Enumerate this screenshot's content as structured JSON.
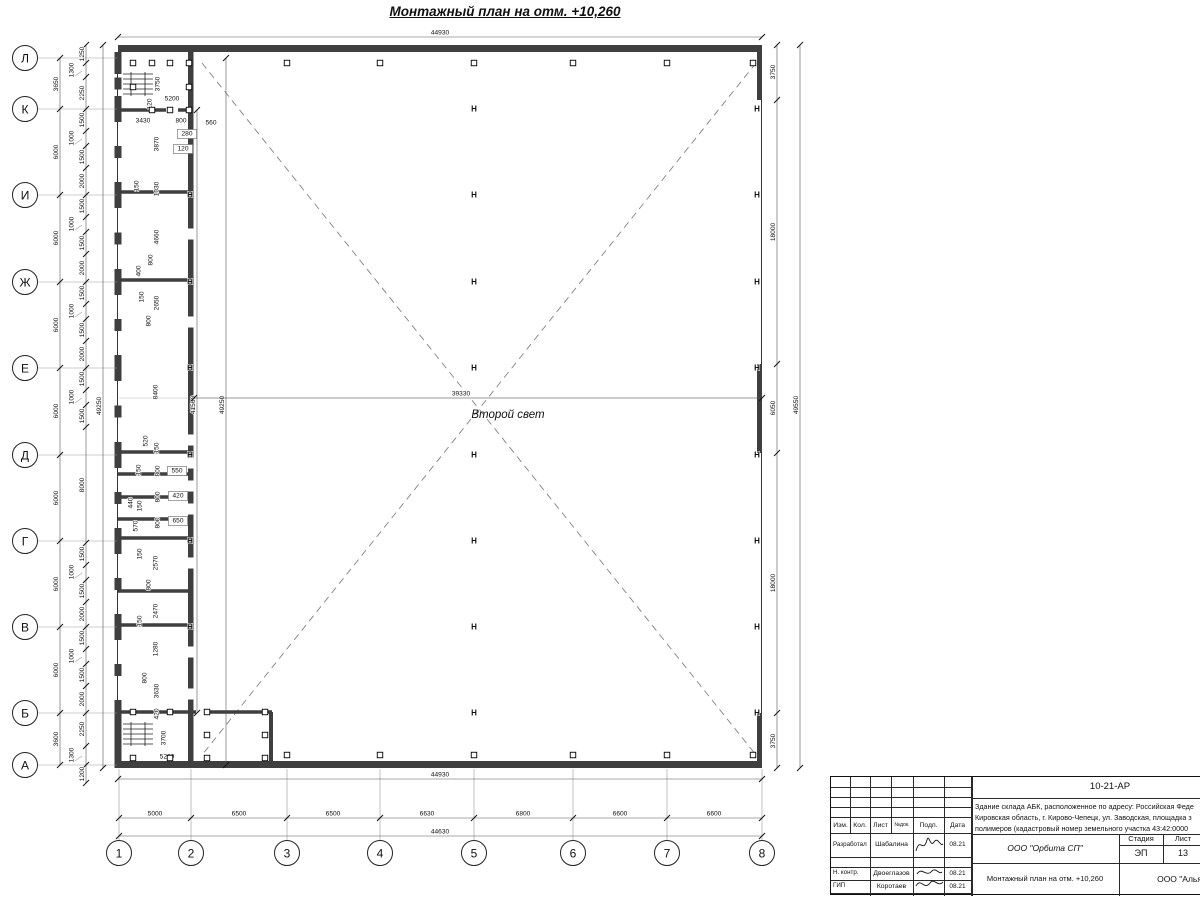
{
  "page_title": "Монтажный план на отм. +10,260",
  "plan": {
    "center_room_label": "Второй свет",
    "axes": {
      "rows": [
        {
          "label": "Л",
          "y": 58
        },
        {
          "label": "К",
          "y": 109
        },
        {
          "label": "И",
          "y": 195
        },
        {
          "label": "Ж",
          "y": 282
        },
        {
          "label": "Е",
          "y": 368
        },
        {
          "label": "Д",
          "y": 455
        },
        {
          "label": "Г",
          "y": 541
        },
        {
          "label": "В",
          "y": 627
        },
        {
          "label": "Б",
          "y": 713
        },
        {
          "label": "А",
          "y": 765
        }
      ],
      "cols": [
        {
          "label": "1",
          "x": 119
        },
        {
          "label": "2",
          "x": 191
        },
        {
          "label": "3",
          "x": 287
        },
        {
          "label": "4",
          "x": 380
        },
        {
          "label": "5",
          "x": 474
        },
        {
          "label": "6",
          "x": 573
        },
        {
          "label": "7",
          "x": 667
        },
        {
          "label": "8",
          "x": 762
        }
      ]
    },
    "chains": [
      {
        "dir": "h",
        "pos": 37,
        "nodes": [
          118,
          762
        ],
        "labels": [
          {
            "t": "44930",
            "at": 440
          }
        ]
      },
      {
        "dir": "h",
        "pos": 779,
        "nodes": [
          118,
          762
        ],
        "labels": [
          {
            "t": "44930",
            "at": 440
          }
        ]
      },
      {
        "dir": "h",
        "pos": 818,
        "nodes": [
          119,
          191,
          287,
          380,
          474,
          573,
          667,
          762
        ],
        "labels": [
          {
            "t": "5000",
            "at": 155
          },
          {
            "t": "6500",
            "at": 239
          },
          {
            "t": "6500",
            "at": 333
          },
          {
            "t": "6630",
            "at": 427
          },
          {
            "t": "6800",
            "at": 523
          },
          {
            "t": "6600",
            "at": 620
          },
          {
            "t": "6600",
            "at": 714
          }
        ]
      },
      {
        "dir": "h",
        "pos": 836,
        "nodes": [
          119,
          762
        ],
        "labels": [
          {
            "t": "44630",
            "at": 440
          }
        ]
      },
      {
        "dir": "v",
        "pos": 60,
        "nodes": [
          58,
          109,
          195,
          282,
          368,
          455,
          541,
          627,
          713,
          765
        ],
        "labels": [
          {
            "t": "3650",
            "at": 84
          },
          {
            "t": "6000",
            "at": 152
          },
          {
            "t": "6000",
            "at": 238
          },
          {
            "t": "6000",
            "at": 325
          },
          {
            "t": "6000",
            "at": 411
          },
          {
            "t": "6000",
            "at": 498
          },
          {
            "t": "6000",
            "at": 584
          },
          {
            "t": "6000",
            "at": 670
          },
          {
            "t": "3600",
            "at": 739
          }
        ]
      },
      {
        "dir": "v",
        "pos": 103,
        "nodes": [
          45,
          768
        ],
        "labels": [
          {
            "t": "49250",
            "at": 406
          }
        ]
      },
      {
        "dir": "v",
        "pos": 86,
        "nodes": [
          45,
          63,
          77,
          109,
          131,
          146,
          168,
          195,
          217,
          232,
          254,
          282,
          304,
          319,
          341,
          368,
          390,
          405,
          427,
          543,
          565,
          580,
          602,
          627,
          649,
          664,
          686,
          713,
          746,
          765,
          783
        ],
        "labels": [
          {
            "t": "1250",
            "at": 54
          },
          {
            "t": "1300",
            "at": 70,
            "l": 1
          },
          {
            "t": "2250",
            "at": 93
          },
          {
            "t": "1500",
            "at": 120
          },
          {
            "t": "1000",
            "at": 138,
            "l": 1
          },
          {
            "t": "1500",
            "at": 157
          },
          {
            "t": "2000",
            "at": 181
          },
          {
            "t": "1500",
            "at": 206
          },
          {
            "t": "1000",
            "at": 224,
            "l": 1
          },
          {
            "t": "1500",
            "at": 243
          },
          {
            "t": "2000",
            "at": 268
          },
          {
            "t": "1500",
            "at": 293
          },
          {
            "t": "1000",
            "at": 311,
            "l": 1
          },
          {
            "t": "1500",
            "at": 330
          },
          {
            "t": "2000",
            "at": 354
          },
          {
            "t": "1500",
            "at": 379
          },
          {
            "t": "1000",
            "at": 397,
            "l": 1
          },
          {
            "t": "1500",
            "at": 416
          },
          {
            "t": "8000",
            "at": 485
          },
          {
            "t": "1500",
            "at": 554
          },
          {
            "t": "1000",
            "at": 572,
            "l": 1
          },
          {
            "t": "1500",
            "at": 591
          },
          {
            "t": "2000",
            "at": 614
          },
          {
            "t": "1500",
            "at": 638
          },
          {
            "t": "1000",
            "at": 656,
            "l": 1
          },
          {
            "t": "1500",
            "at": 675
          },
          {
            "t": "2000",
            "at": 699
          },
          {
            "t": "2250",
            "at": 729
          },
          {
            "t": "1300",
            "at": 755,
            "l": 1
          },
          {
            "t": "1200",
            "at": 774
          }
        ]
      },
      {
        "dir": "v",
        "pos": 777,
        "nodes": [
          45,
          100,
          364,
          453,
          713,
          768
        ],
        "labels": [
          {
            "t": "3750",
            "at": 72
          },
          {
            "t": "18000",
            "at": 232
          },
          {
            "t": "6050",
            "at": 408
          },
          {
            "t": "18000",
            "at": 583
          },
          {
            "t": "3750",
            "at": 741
          }
        ]
      },
      {
        "dir": "v",
        "pos": 800,
        "nodes": [
          45,
          768
        ],
        "labels": [
          {
            "t": "49550",
            "at": 405
          }
        ]
      },
      {
        "dir": "v",
        "pos": 197,
        "nodes": [
          110,
          713
        ],
        "labels": [
          {
            "t": "41560",
            "at": 405
          }
        ]
      },
      {
        "dir": "v",
        "pos": 226,
        "nodes": [
          58,
          765
        ],
        "labels": [
          {
            "t": "49250",
            "at": 405
          }
        ]
      },
      {
        "dir": "h",
        "pos": 398,
        "nodes": [
          194,
          762
        ],
        "labels": [
          {
            "t": "39330",
            "at": 461
          }
        ]
      }
    ],
    "detail_dims": [
      [
        "3750",
        158,
        84,
        1,
        0
      ],
      [
        "5200",
        172,
        99,
        0,
        0
      ],
      [
        "120",
        150,
        104,
        1,
        0
      ],
      [
        "3430",
        143,
        121,
        0,
        0
      ],
      [
        "800",
        181,
        121,
        0,
        0
      ],
      [
        "560",
        211,
        123,
        0,
        0
      ],
      [
        "280",
        187,
        134,
        0,
        1
      ],
      [
        "120",
        183,
        149,
        0,
        1
      ],
      [
        "3870",
        157,
        144,
        1,
        0
      ],
      [
        "150",
        137,
        186,
        1,
        0
      ],
      [
        "1030",
        157,
        189,
        1,
        0
      ],
      [
        "4660",
        157,
        237,
        1,
        0
      ],
      [
        "800",
        151,
        260,
        1,
        0
      ],
      [
        "400",
        139,
        271,
        1,
        0
      ],
      [
        "150",
        142,
        297,
        1,
        0
      ],
      [
        "2650",
        157,
        303,
        1,
        0
      ],
      [
        "800",
        149,
        321,
        1,
        0
      ],
      [
        "8400",
        156,
        392,
        1,
        0
      ],
      [
        "520",
        146,
        441,
        1,
        0
      ],
      [
        "150",
        157,
        448,
        1,
        0
      ],
      [
        "150",
        139,
        470,
        1,
        0
      ],
      [
        "800",
        158,
        471,
        1,
        0
      ],
      [
        "550",
        177,
        471,
        0,
        1
      ],
      [
        "440",
        131,
        503,
        1,
        0
      ],
      [
        "150",
        140,
        506,
        1,
        0
      ],
      [
        "800",
        158,
        497,
        1,
        0
      ],
      [
        "420",
        178,
        496,
        0,
        1
      ],
      [
        "570",
        136,
        526,
        1,
        0
      ],
      [
        "800",
        158,
        523,
        1,
        0
      ],
      [
        "650",
        178,
        521,
        0,
        1
      ],
      [
        "150",
        140,
        554,
        1,
        0
      ],
      [
        "2570",
        156,
        563,
        1,
        0
      ],
      [
        "800",
        149,
        585,
        1,
        0
      ],
      [
        "2470",
        156,
        611,
        1,
        0
      ],
      [
        "150",
        140,
        621,
        1,
        0
      ],
      [
        "1280",
        156,
        649,
        1,
        0
      ],
      [
        "800",
        145,
        678,
        1,
        0
      ],
      [
        "3630",
        157,
        691,
        1,
        0
      ],
      [
        "420",
        157,
        714,
        1,
        0
      ],
      [
        "3700",
        164,
        738,
        1,
        0
      ],
      [
        "5200",
        167,
        757,
        0,
        0
      ]
    ],
    "h_marks": [
      [
        474,
        109
      ],
      [
        474,
        195
      ],
      [
        474,
        282
      ],
      [
        474,
        368
      ],
      [
        474,
        455
      ],
      [
        474,
        541
      ],
      [
        474,
        627
      ],
      [
        474,
        713
      ],
      [
        757,
        109
      ],
      [
        757,
        195
      ],
      [
        757,
        282
      ],
      [
        757,
        368
      ],
      [
        757,
        455
      ],
      [
        757,
        541
      ],
      [
        757,
        627
      ],
      [
        757,
        713
      ],
      [
        190,
        195
      ],
      [
        190,
        282
      ],
      [
        190,
        368
      ],
      [
        190,
        455
      ],
      [
        190,
        541
      ],
      [
        190,
        627
      ]
    ],
    "squares": [
      [
        287,
        63
      ],
      [
        380,
        63
      ],
      [
        474,
        63
      ],
      [
        573,
        63
      ],
      [
        667,
        63
      ],
      [
        753,
        63
      ],
      [
        287,
        755
      ],
      [
        380,
        755
      ],
      [
        474,
        755
      ],
      [
        573,
        755
      ],
      [
        667,
        755
      ],
      [
        753,
        755
      ],
      [
        133,
        63
      ],
      [
        152,
        63
      ],
      [
        170,
        63
      ],
      [
        189,
        63
      ],
      [
        133,
        87
      ],
      [
        189,
        87
      ],
      [
        152,
        110
      ],
      [
        170,
        110
      ],
      [
        189,
        110
      ],
      [
        133,
        712
      ],
      [
        170,
        712
      ],
      [
        207,
        712
      ],
      [
        265,
        712
      ],
      [
        207,
        735
      ],
      [
        265,
        735
      ],
      [
        133,
        758
      ],
      [
        170,
        758
      ],
      [
        207,
        758
      ],
      [
        265,
        758
      ]
    ],
    "doors": [
      234,
      322,
      440,
      463,
      486,
      509,
      563,
      652,
      694
    ],
    "partitions": [
      {
        "y": 110,
        "x1": 118,
        "x2": 193,
        "gap": [
          166,
          178
        ]
      },
      {
        "y": 192,
        "x1": 118,
        "x2": 193
      },
      {
        "y": 280,
        "x1": 118,
        "x2": 193
      },
      {
        "y": 452,
        "x1": 118,
        "x2": 193
      },
      {
        "y": 474,
        "x1": 118,
        "x2": 193
      },
      {
        "y": 497,
        "x1": 118,
        "x2": 193
      },
      {
        "y": 519,
        "x1": 118,
        "x2": 193
      },
      {
        "y": 538,
        "x1": 118,
        "x2": 193
      },
      {
        "y": 591,
        "x1": 118,
        "x2": 193
      },
      {
        "y": 625,
        "x1": 118,
        "x2": 193
      },
      {
        "y": 712,
        "x1": 118,
        "x2": 272,
        "gap": [
          196,
          208
        ]
      }
    ]
  },
  "titleblock": {
    "code": "10-21-АР",
    "description_lines": [
      "Здание склада АБК, расположенное по адресу: Российская Феде",
      "Кировская область, г. Кирово-Чепецк, ул. Заводская, площадка з",
      "полимеров (кадастровый номер земельного участка 43:42:0000"
    ],
    "columns": {
      "izm": "Изм.",
      "kol": "Кол.",
      "list": "Лист",
      "ndok": "№док.",
      "podp": "Подп.",
      "data": "Дата"
    },
    "signers": [
      {
        "role": "Разработал",
        "name": "Шабалина",
        "date": "08.21"
      },
      {
        "role": "Н. контр.",
        "name": "Двоеглазов",
        "date": "08.21"
      },
      {
        "role": "ГИП",
        "name": "Коротаев",
        "date": "08.21"
      }
    ],
    "org": "ООО \"Орбита СП\"",
    "stage": {
      "stage_label": "Стадия",
      "sheet_label": "Лист",
      "sheets_label": "Листов",
      "stage_value": "ЭП",
      "sheet_value": "13",
      "sheets_value": "1"
    },
    "doc_title": "Монтажный план на отм. +10,260",
    "company": "ООО \"Альянс"
  }
}
